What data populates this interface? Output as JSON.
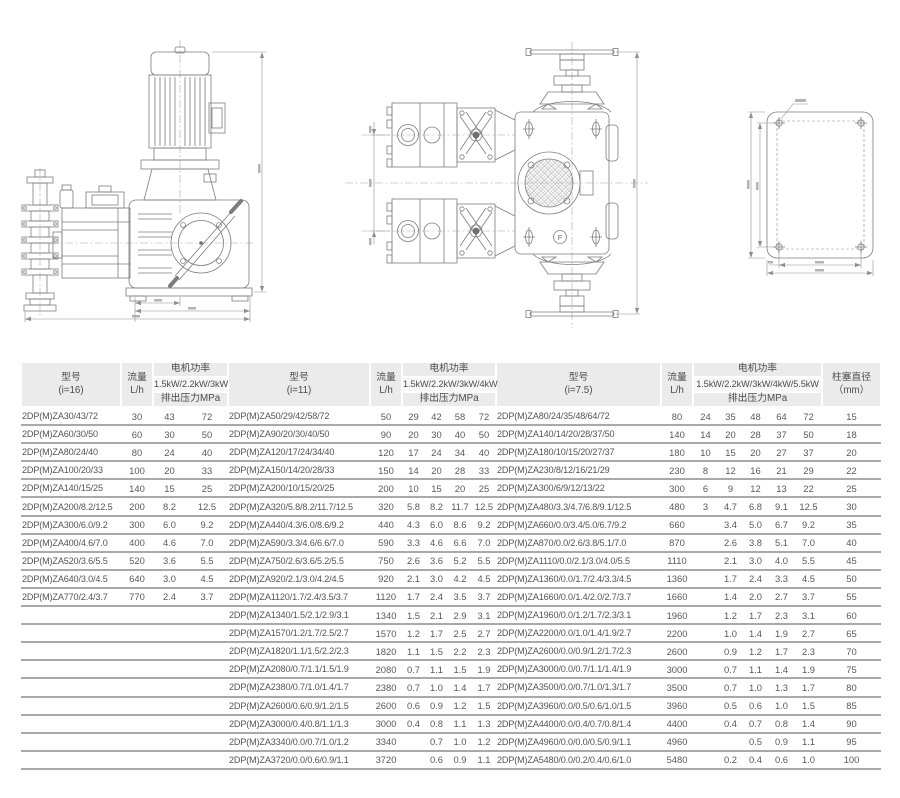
{
  "colors": {
    "header_bg": "#ebebeb",
    "subheader_bg": "#f7f7f7",
    "row_line": "#a9a9a9",
    "text": "#555555",
    "drawing_stroke": "#7d7d7d"
  },
  "drawings": {
    "top_view_marker": "F"
  },
  "table": {
    "plunger_line1": "柱塞直径",
    "plunger_line2": "（mm）",
    "groups": [
      {
        "model_line1": "型号",
        "model_line2": "(i=16)",
        "flow_line1": "流量",
        "flow_line2": "L/h",
        "power": "电机功率",
        "kw": "1.5kW/2.2kW/3kW",
        "pressure": "排出压力MPa",
        "rows": [
          {
            "model": "2DP(M)ZA30/43/72",
            "flow": "30",
            "p": [
              "43",
              "72"
            ]
          },
          {
            "model": "2DP(M)ZA60/30/50",
            "flow": "60",
            "p": [
              "30",
              "50"
            ]
          },
          {
            "model": "2DP(M)ZA80/24/40",
            "flow": "80",
            "p": [
              "24",
              "40"
            ]
          },
          {
            "model": "2DP(M)ZA100/20/33",
            "flow": "100",
            "p": [
              "20",
              "33"
            ]
          },
          {
            "model": "2DP(M)ZA140/15/25",
            "flow": "140",
            "p": [
              "15",
              "25"
            ]
          },
          {
            "model": "2DP(M)ZA200/8.2/12.5",
            "flow": "200",
            "p": [
              "8.2",
              "12.5"
            ]
          },
          {
            "model": "2DP(M)ZA300/6.0/9.2",
            "flow": "300",
            "p": [
              "6.0",
              "9.2"
            ]
          },
          {
            "model": "2DP(M)ZA400/4.6/7.0",
            "flow": "400",
            "p": [
              "4.6",
              "7.0"
            ]
          },
          {
            "model": "2DP(M)ZA520/3.6/5.5",
            "flow": "520",
            "p": [
              "3.6",
              "5.5"
            ]
          },
          {
            "model": "2DP(M)ZA640/3.0/4.5",
            "flow": "640",
            "p": [
              "3.0",
              "4.5"
            ]
          },
          {
            "model": "2DP(M)ZA770/2.4/3.7",
            "flow": "770",
            "p": [
              "2.4",
              "3.7"
            ]
          }
        ]
      },
      {
        "model_line1": "型号",
        "model_line2": "(i=11)",
        "flow_line1": "流量",
        "flow_line2": "L/h",
        "power": "电机功率",
        "kw": "1.5kW/2.2kW/3kW/4kW",
        "pressure": "排出压力MPa",
        "rows": [
          {
            "model": "2DP(M)ZA50/29/42/58/72",
            "flow": "50",
            "p": [
              "29",
              "42",
              "58",
              "72"
            ]
          },
          {
            "model": "2DP(M)ZA90/20/30/40/50",
            "flow": "90",
            "p": [
              "20",
              "30",
              "40",
              "50"
            ]
          },
          {
            "model": "2DP(M)ZA120/17/24/34/40",
            "flow": "120",
            "p": [
              "17",
              "24",
              "34",
              "40"
            ]
          },
          {
            "model": "2DP(M)ZA150/14/20/28/33",
            "flow": "150",
            "p": [
              "14",
              "20",
              "28",
              "33"
            ]
          },
          {
            "model": "2DP(M)ZA200/10/15/20/25",
            "flow": "200",
            "p": [
              "10",
              "15",
              "20",
              "25"
            ]
          },
          {
            "model": "2DP(M)ZA320/5.8/8.2/11.7/12.5",
            "flow": "320",
            "p": [
              "5.8",
              "8.2",
              "11.7",
              "12.5"
            ]
          },
          {
            "model": "2DP(M)ZA440/4.3/6.0/8.6/9.2",
            "flow": "440",
            "p": [
              "4.3",
              "6.0",
              "8.6",
              "9.2"
            ]
          },
          {
            "model": "2DP(M)ZA590/3.3/4.6/6.6/7.0",
            "flow": "590",
            "p": [
              "3.3",
              "4.6",
              "6.6",
              "7.0"
            ]
          },
          {
            "model": "2DP(M)ZA750/2.6/3.6/5.2/5.5",
            "flow": "750",
            "p": [
              "2.6",
              "3.6",
              "5.2",
              "5.5"
            ]
          },
          {
            "model": "2DP(M)ZA920/2.1/3.0/4.2/4.5",
            "flow": "920",
            "p": [
              "2.1",
              "3.0",
              "4.2",
              "4.5"
            ]
          },
          {
            "model": "2DP(M)ZA1120/1.7/2.4/3.5/3.7",
            "flow": "1120",
            "p": [
              "1.7",
              "2.4",
              "3.5",
              "3.7"
            ]
          },
          {
            "model": "2DP(M)ZA1340/1.5/2.1/2.9/3.1",
            "flow": "1340",
            "p": [
              "1.5",
              "2.1",
              "2.9",
              "3.1"
            ]
          },
          {
            "model": "2DP(M)ZA1570/1.2/1.7/2.5/2.7",
            "flow": "1570",
            "p": [
              "1.2",
              "1.7",
              "2.5",
              "2.7"
            ]
          },
          {
            "model": "2DP(M)ZA1820/1.1/1.5/2.2/2.3",
            "flow": "1820",
            "p": [
              "1.1",
              "1.5",
              "2.2",
              "2.3"
            ]
          },
          {
            "model": "2DP(M)ZA2080/0.7/1.1/1.5/1.9",
            "flow": "2080",
            "p": [
              "0.7",
              "1.1",
              "1.5",
              "1.9"
            ]
          },
          {
            "model": "2DP(M)ZA2380/0.7/1.0/1.4/1.7",
            "flow": "2380",
            "p": [
              "0.7",
              "1.0",
              "1.4",
              "1.7"
            ]
          },
          {
            "model": "2DP(M)ZA2600/0.6/0.9/1.2/1.5",
            "flow": "2600",
            "p": [
              "0.6",
              "0.9",
              "1.2",
              "1.5"
            ]
          },
          {
            "model": "2DP(M)ZA3000/0.4/0.8/1.1/1.3",
            "flow": "3000",
            "p": [
              "0.4",
              "0.8",
              "1.1",
              "1.3"
            ]
          },
          {
            "model": "2DP(M)ZA3340/0.0/0.7/1.0/1.2",
            "flow": "3340",
            "p": [
              "",
              "0.7",
              "1.0",
              "1.2"
            ]
          },
          {
            "model": "2DP(M)ZA3720/0.0/0.6/0.9/1.1",
            "flow": "3720",
            "p": [
              "",
              "0.6",
              "0.9",
              "1.1"
            ]
          }
        ]
      },
      {
        "model_line1": "型号",
        "model_line2": "(i=7.5)",
        "flow_line1": "流量",
        "flow_line2": "L/h",
        "power": "电机功率",
        "kw": "1.5kW/2.2kW/3kW/4kW/5.5kW",
        "pressure": "排出压力MPa",
        "rows": [
          {
            "model": "2DP(M)ZA80/24/35/48/64/72",
            "flow": "80",
            "p": [
              "24",
              "35",
              "48",
              "64",
              "72"
            ],
            "plunger": "15"
          },
          {
            "model": "2DP(M)ZA140/14/20/28/37/50",
            "flow": "140",
            "p": [
              "14",
              "20",
              "28",
              "37",
              "50"
            ],
            "plunger": "18"
          },
          {
            "model": "2DP(M)ZA180/10/15/20/27/37",
            "flow": "180",
            "p": [
              "10",
              "15",
              "20",
              "27",
              "37"
            ],
            "plunger": "20"
          },
          {
            "model": "2DP(M)ZA230/8/12/16/21/29",
            "flow": "230",
            "p": [
              "8",
              "12",
              "16",
              "21",
              "29"
            ],
            "plunger": "22"
          },
          {
            "model": "2DP(M)ZA300/6/9/12/13/22",
            "flow": "300",
            "p": [
              "6",
              "9",
              "12",
              "13",
              "22"
            ],
            "plunger": "25"
          },
          {
            "model": "2DP(M)ZA480/3.3/4.7/6.8/9.1/12.5",
            "flow": "480",
            "p": [
              "3",
              "4.7",
              "6.8",
              "9.1",
              "12.5"
            ],
            "plunger": "30"
          },
          {
            "model": "2DP(M)ZA660/0.0/3.4/5.0/6.7/9.2",
            "flow": "660",
            "p": [
              "",
              "3.4",
              "5.0",
              "6.7",
              "9.2"
            ],
            "plunger": "35"
          },
          {
            "model": "2DP(M)ZA870/0.0/2.6/3.8/5.1/7.0",
            "flow": "870",
            "p": [
              "",
              "2.6",
              "3.8",
              "5.1",
              "7.0"
            ],
            "plunger": "40"
          },
          {
            "model": "2DP(M)ZA1110/0.0/2.1/3.0/4.0/5.5",
            "flow": "1110",
            "p": [
              "",
              "2.1",
              "3.0",
              "4.0",
              "5.5"
            ],
            "plunger": "45"
          },
          {
            "model": "2DP(M)ZA1360/0.0/1.7/2.4/3.3/4.5",
            "flow": "1360",
            "p": [
              "",
              "1.7",
              "2.4",
              "3.3",
              "4.5"
            ],
            "plunger": "50"
          },
          {
            "model": "2DP(M)ZA1660/0.0/1.4/2.0/2.7/3.7",
            "flow": "1660",
            "p": [
              "",
              "1.4",
              "2.0",
              "2.7",
              "3.7"
            ],
            "plunger": "55"
          },
          {
            "model": "2DP(M)ZA1960/0.0/1.2/1.7/2.3/3.1",
            "flow": "1960",
            "p": [
              "",
              "1.2",
              "1.7",
              "2.3",
              "3.1"
            ],
            "plunger": "60"
          },
          {
            "model": "2DP(M)ZA2200/0.0/1.0/1.4/1.9/2.7",
            "flow": "2200",
            "p": [
              "",
              "1.0",
              "1.4",
              "1.9",
              "2.7"
            ],
            "plunger": "65"
          },
          {
            "model": "2DP(M)ZA2600/0.0/0.9/1.2/1.7/2.3",
            "flow": "2600",
            "p": [
              "",
              "0.9",
              "1.2",
              "1.7",
              "2.3"
            ],
            "plunger": "70"
          },
          {
            "model": "2DP(M)ZA3000/0.0/0.7/1.1/1.4/1.9",
            "flow": "3000",
            "p": [
              "",
              "0.7",
              "1.1",
              "1.4",
              "1.9"
            ],
            "plunger": "75"
          },
          {
            "model": "2DP(M)ZA3500/0.0/0.7/1.0/1.3/1.7",
            "flow": "3500",
            "p": [
              "",
              "0.7",
              "1.0",
              "1.3",
              "1.7"
            ],
            "plunger": "80"
          },
          {
            "model": "2DP(M)ZA3960/0.0/0.5/0.6/1.0/1.5",
            "flow": "3960",
            "p": [
              "",
              "0.5",
              "0.6",
              "1.0",
              "1.5"
            ],
            "plunger": "85"
          },
          {
            "model": "2DP(M)ZA4400/0.0/0.4/0.7/0.8/1.4",
            "flow": "4400",
            "p": [
              "",
              "0.4",
              "0.7",
              "0.8",
              "1.4"
            ],
            "plunger": "90"
          },
          {
            "model": "2DP(M)ZA4960/0.0/0.0/0.5/0.9/1.1",
            "flow": "4960",
            "p": [
              "",
              "",
              "0.5",
              "0.9",
              "1.1"
            ],
            "plunger": "95"
          },
          {
            "model": "2DP(M)ZA5480/0.0/0.2/0.4/0.6/1.0",
            "flow": "5480",
            "p": [
              "",
              "0.2",
              "0.4",
              "0.6",
              "1.0"
            ],
            "plunger": "100"
          }
        ]
      }
    ]
  }
}
